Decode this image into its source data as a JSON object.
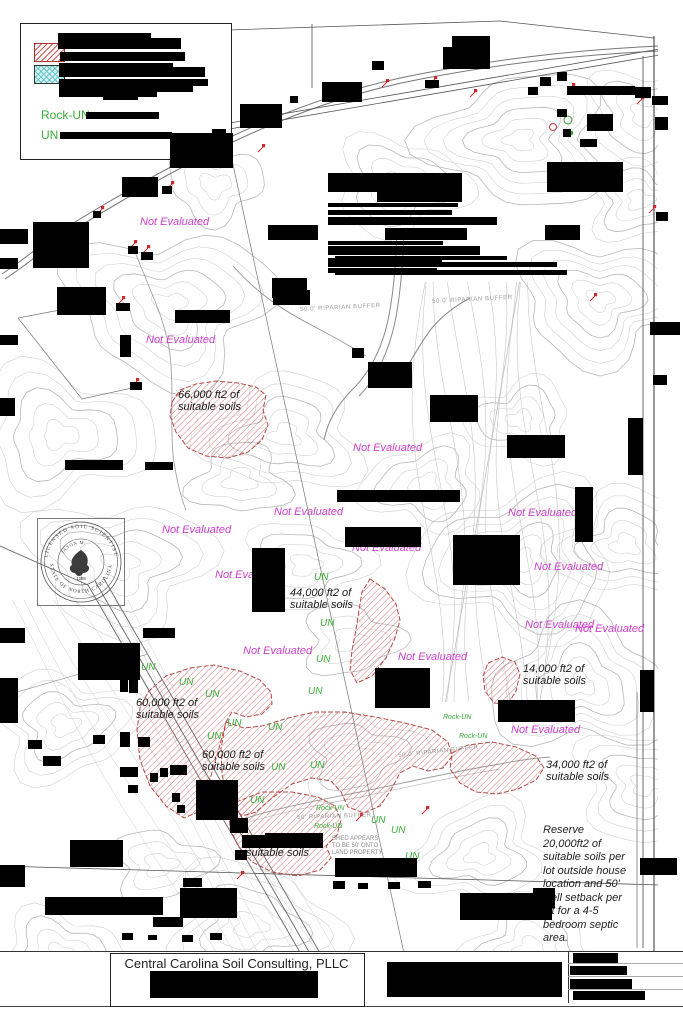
{
  "colors": {
    "magenta": "#cb3fcb",
    "green": "#3aae3a",
    "soil_red": "#c0504d",
    "contour": "#cccccc"
  },
  "legend": {
    "rock_un_label": "Rock-UN",
    "un_label": "UN",
    "swatches": [
      {
        "name": "suitable-soil-hatch"
      },
      {
        "name": "provisionally-suitable-hatch"
      }
    ]
  },
  "seal": {
    "arc_top": "LICENSED SOIL SCIENTIST",
    "arc_bottom": "STATE OF NORTH CAROLINA",
    "name": "JASON M.",
    "number": "1288"
  },
  "title_block": {
    "company": "Central Carolina Soil Consulting, PLLC"
  },
  "notes": {
    "reserve_lines": [
      "Reserve",
      "20,000ft2 of",
      "suitable soils per",
      "lot outside house",
      "location and 50'",
      "well setback per",
      "lot for a 4-5",
      "bedroom septic",
      "area."
    ],
    "shed_lines": [
      "SHED APPEARS",
      "TO BE 50' ONTO",
      "LAND PROPERTY"
    ],
    "shed_x": 332,
    "shed_y": 836
  },
  "labels": {
    "not_evaluated_text": "Not Evaluated",
    "not_evaluated": [
      [
        140,
        216
      ],
      [
        146,
        334
      ],
      [
        353,
        442
      ],
      [
        274,
        506
      ],
      [
        162,
        524
      ],
      [
        508,
        507
      ],
      [
        215,
        569
      ],
      [
        534,
        561
      ],
      [
        352,
        542
      ],
      [
        525,
        619
      ],
      [
        575,
        623
      ],
      [
        243,
        645
      ],
      [
        398,
        651
      ],
      [
        511,
        724
      ]
    ],
    "un_text": "UN",
    "un": [
      [
        314,
        572
      ],
      [
        320,
        618
      ],
      [
        316,
        654
      ],
      [
        308,
        686
      ],
      [
        141,
        662
      ],
      [
        179,
        677
      ],
      [
        205,
        689
      ],
      [
        227,
        718
      ],
      [
        207,
        731
      ],
      [
        268,
        722
      ],
      [
        271,
        762
      ],
      [
        250,
        795
      ],
      [
        310,
        760
      ],
      [
        371,
        815
      ],
      [
        391,
        825
      ],
      [
        405,
        851
      ]
    ],
    "rock_un_text": "Rock-UN",
    "rock_un": [
      [
        316,
        805
      ],
      [
        314,
        823
      ],
      [
        443,
        714
      ],
      [
        459,
        733
      ]
    ],
    "buffers": [
      {
        "x": 300,
        "y": 307,
        "rot": -3,
        "text": "50.0' RIPARIAN BUFFER"
      },
      {
        "x": 432,
        "y": 299,
        "rot": -3,
        "text": "50.0' RIPARIAN BUFFER"
      },
      {
        "x": 297,
        "y": 815,
        "rot": -2,
        "text": "50' RIPARIAN BUFFER"
      },
      {
        "x": 398,
        "y": 753,
        "rot": -6,
        "text": "50.0' RIPARIAN BUFFER"
      }
    ]
  },
  "soil_areas": [
    {
      "label_lines": [
        "66,000 ft2 of",
        "suitable soils"
      ],
      "label_x": 178,
      "label_y": 390,
      "points": "172,402 180,390 196,384 216,381 238,383 256,387 266,395 263,410 268,425 262,440 248,452 228,458 206,456 188,448 176,432 170,416"
    },
    {
      "label_lines": [
        "44,000 ft2 of",
        "suitable soils"
      ],
      "label_x": 290,
      "label_y": 588,
      "points": "370,579 385,589 396,604 400,620 395,638 386,658 372,676 357,683 350,670 352,650 356,630 359,610 362,592"
    },
    {
      "label_lines": [
        "60,000 ft2 of",
        "suitable soils"
      ],
      "label_x": 136,
      "label_y": 698,
      "points": "148,692 166,676 190,668 214,665 240,671 260,680 271,692 272,704 262,714 246,717 232,712 226,722 218,752 208,786 198,812 184,818 166,806 150,786 140,760 137,730 140,708"
    },
    {
      "label_lines": [
        "60,000 ft2 of",
        "suitable soils"
      ],
      "label_x": 202,
      "label_y": 750,
      "points": "226,722 244,728 262,726 288,718 315,712 345,712 375,717 405,723 432,730 448,742 452,756 443,768 428,771 413,766 400,773 391,790 380,806 364,813 348,807 341,792 331,781 312,778 292,784 272,798 256,812 242,816 230,802 222,775 221,748"
    },
    {
      "label_lines": [
        "2,",
        "suitable soils"
      ],
      "label_x": 246,
      "label_y": 836,
      "points": "236,802 262,792 292,792 318,797 335,806 341,820 337,835 326,846 331,858 320,870 298,876 272,872 252,862 238,846 230,828 229,812"
    },
    {
      "label_lines": [
        "14,000 ft2 of",
        "suitable soils"
      ],
      "label_x": 523,
      "label_y": 664,
      "points": "488,663 502,657 515,662 520,674 516,691 508,704 494,703 485,691 483,676"
    },
    {
      "label_lines": [
        "34,000 ft2 of",
        "suitable soils"
      ],
      "label_x": 546,
      "label_y": 760,
      "points": "452,753 468,745 492,742 516,747 536,756 544,768 536,780 518,789 497,794 476,792 460,783 450,769"
    }
  ],
  "sample_markers": [
    [
      97,
      214
    ],
    [
      130,
      248
    ],
    [
      143,
      253
    ],
    [
      167,
      189
    ],
    [
      258,
      152
    ],
    [
      382,
      87
    ],
    [
      430,
      84
    ],
    [
      470,
      97
    ],
    [
      568,
      91
    ],
    [
      637,
      104
    ],
    [
      649,
      213
    ],
    [
      590,
      301
    ],
    [
      422,
      814
    ],
    [
      356,
      821
    ],
    [
      118,
      304
    ],
    [
      132,
      386
    ],
    [
      237,
      879
    ]
  ],
  "marker_circles": [
    {
      "x": 553,
      "y": 127,
      "r": 3.5,
      "c": "#cc3344",
      "f": "none"
    },
    {
      "x": 568,
      "y": 120,
      "r": 4,
      "c": "#2f9e2f",
      "f": "none"
    },
    {
      "x": 571,
      "y": 133,
      "r": 1.8,
      "c": "#2f9e2f",
      "f": "#2f9e2f"
    },
    {
      "x": 559,
      "y": 113,
      "r": 1.5,
      "c": "#333",
      "f": "#333"
    }
  ],
  "redactions": [
    [
      58,
      33,
      93,
      16
    ],
    [
      151,
      38,
      30,
      11
    ],
    [
      60,
      52,
      125,
      9
    ],
    [
      59,
      63,
      114,
      14
    ],
    [
      173,
      67,
      32,
      10
    ],
    [
      59,
      79,
      134,
      13
    ],
    [
      181,
      79,
      27,
      7
    ],
    [
      59,
      92,
      98,
      5
    ],
    [
      103,
      94,
      35,
      6
    ],
    [
      86,
      112,
      73,
      7
    ],
    [
      60,
      132,
      112,
      7
    ],
    [
      170,
      133,
      63,
      35
    ],
    [
      240,
      104,
      42,
      24
    ],
    [
      322,
      82,
      40,
      20
    ],
    [
      372,
      61,
      12,
      9
    ],
    [
      425,
      80,
      14,
      8
    ],
    [
      443,
      47,
      47,
      22
    ],
    [
      452,
      36,
      38,
      13
    ],
    [
      290,
      96,
      8,
      7
    ],
    [
      212,
      129,
      14,
      16
    ],
    [
      122,
      177,
      36,
      20
    ],
    [
      162,
      186,
      10,
      8
    ],
    [
      93,
      211,
      8,
      7
    ],
    [
      128,
      246,
      10,
      8
    ],
    [
      141,
      252,
      12,
      8
    ],
    [
      567,
      86,
      68,
      9
    ],
    [
      635,
      87,
      16,
      11
    ],
    [
      652,
      96,
      16,
      9
    ],
    [
      587,
      114,
      26,
      17
    ],
    [
      655,
      117,
      13,
      13
    ],
    [
      557,
      109,
      10,
      8
    ],
    [
      563,
      129,
      8,
      8
    ],
    [
      580,
      139,
      17,
      8
    ],
    [
      540,
      77,
      11,
      9
    ],
    [
      557,
      72,
      10,
      9
    ],
    [
      528,
      87,
      10,
      8
    ],
    [
      547,
      162,
      76,
      30
    ],
    [
      33,
      222,
      56,
      46
    ],
    [
      0,
      229,
      28,
      15
    ],
    [
      0,
      258,
      18,
      11
    ],
    [
      57,
      287,
      49,
      28
    ],
    [
      116,
      303,
      14,
      8
    ],
    [
      120,
      335,
      11,
      22
    ],
    [
      130,
      382,
      12,
      8
    ],
    [
      175,
      310,
      55,
      13
    ],
    [
      0,
      335,
      18,
      10
    ],
    [
      0,
      398,
      15,
      18
    ],
    [
      65,
      460,
      58,
      10
    ],
    [
      145,
      462,
      28,
      8
    ],
    [
      328,
      173,
      134,
      19
    ],
    [
      377,
      192,
      85,
      10
    ],
    [
      328,
      203,
      130,
      4
    ],
    [
      328,
      210,
      124,
      5
    ],
    [
      328,
      217,
      169,
      8
    ],
    [
      268,
      225,
      50,
      15
    ],
    [
      385,
      228,
      82,
      12
    ],
    [
      545,
      225,
      35,
      15
    ],
    [
      328,
      241,
      115,
      4
    ],
    [
      328,
      246,
      152,
      9
    ],
    [
      335,
      256,
      172,
      4
    ],
    [
      328,
      258,
      114,
      9
    ],
    [
      442,
      262,
      115,
      5
    ],
    [
      328,
      268,
      109,
      5
    ],
    [
      335,
      270,
      232,
      5
    ],
    [
      272,
      278,
      35,
      20
    ],
    [
      273,
      290,
      37,
      15
    ],
    [
      352,
      348,
      12,
      10
    ],
    [
      368,
      362,
      44,
      26
    ],
    [
      430,
      395,
      48,
      27
    ],
    [
      507,
      435,
      58,
      23
    ],
    [
      628,
      418,
      15,
      57
    ],
    [
      650,
      322,
      30,
      13
    ],
    [
      653,
      375,
      14,
      10
    ],
    [
      337,
      490,
      123,
      12
    ],
    [
      345,
      527,
      76,
      20
    ],
    [
      453,
      535,
      67,
      50
    ],
    [
      575,
      487,
      18,
      55
    ],
    [
      252,
      548,
      33,
      64
    ],
    [
      143,
      628,
      32,
      10
    ],
    [
      78,
      643,
      62,
      37
    ],
    [
      0,
      628,
      25,
      15
    ],
    [
      375,
      668,
      55,
      40
    ],
    [
      498,
      700,
      77,
      22
    ],
    [
      640,
      670,
      14,
      42
    ],
    [
      656,
      212,
      12,
      9
    ],
    [
      120,
      670,
      8,
      22
    ],
    [
      129,
      668,
      9,
      25
    ],
    [
      120,
      732,
      10,
      15
    ],
    [
      138,
      737,
      12,
      10
    ],
    [
      120,
      767,
      18,
      10
    ],
    [
      128,
      785,
      10,
      8
    ],
    [
      150,
      773,
      8,
      9
    ],
    [
      160,
      768,
      8,
      9
    ],
    [
      170,
      765,
      17,
      10
    ],
    [
      197,
      783,
      10,
      9
    ],
    [
      172,
      793,
      8,
      9
    ],
    [
      177,
      805,
      8,
      8
    ],
    [
      196,
      780,
      42,
      40
    ],
    [
      230,
      818,
      18,
      15
    ],
    [
      242,
      835,
      23,
      13
    ],
    [
      265,
      833,
      58,
      15
    ],
    [
      235,
      850,
      12,
      10
    ],
    [
      28,
      740,
      14,
      9
    ],
    [
      43,
      756,
      18,
      10
    ],
    [
      93,
      735,
      12,
      9
    ],
    [
      0,
      678,
      18,
      45
    ],
    [
      70,
      840,
      53,
      27
    ],
    [
      45,
      897,
      118,
      18
    ],
    [
      180,
      888,
      57,
      30
    ],
    [
      153,
      917,
      30,
      10
    ],
    [
      183,
      878,
      19,
      9
    ],
    [
      0,
      865,
      25,
      22
    ],
    [
      122,
      933,
      11,
      7
    ],
    [
      148,
      935,
      9,
      5
    ],
    [
      182,
      935,
      11,
      7
    ],
    [
      210,
      933,
      12,
      7
    ],
    [
      333,
      881,
      12,
      8
    ],
    [
      358,
      883,
      10,
      6
    ],
    [
      388,
      882,
      12,
      7
    ],
    [
      418,
      881,
      13,
      7
    ],
    [
      335,
      858,
      82,
      19
    ],
    [
      460,
      893,
      92,
      27
    ],
    [
      533,
      888,
      22,
      20
    ],
    [
      640,
      858,
      37,
      17
    ],
    [
      150,
      971,
      168,
      27
    ],
    [
      387,
      962,
      175,
      35
    ],
    [
      573,
      953,
      45,
      10
    ],
    [
      570,
      966,
      57,
      9
    ],
    [
      570,
      979,
      62,
      10
    ],
    [
      573,
      991,
      72,
      9
    ]
  ]
}
